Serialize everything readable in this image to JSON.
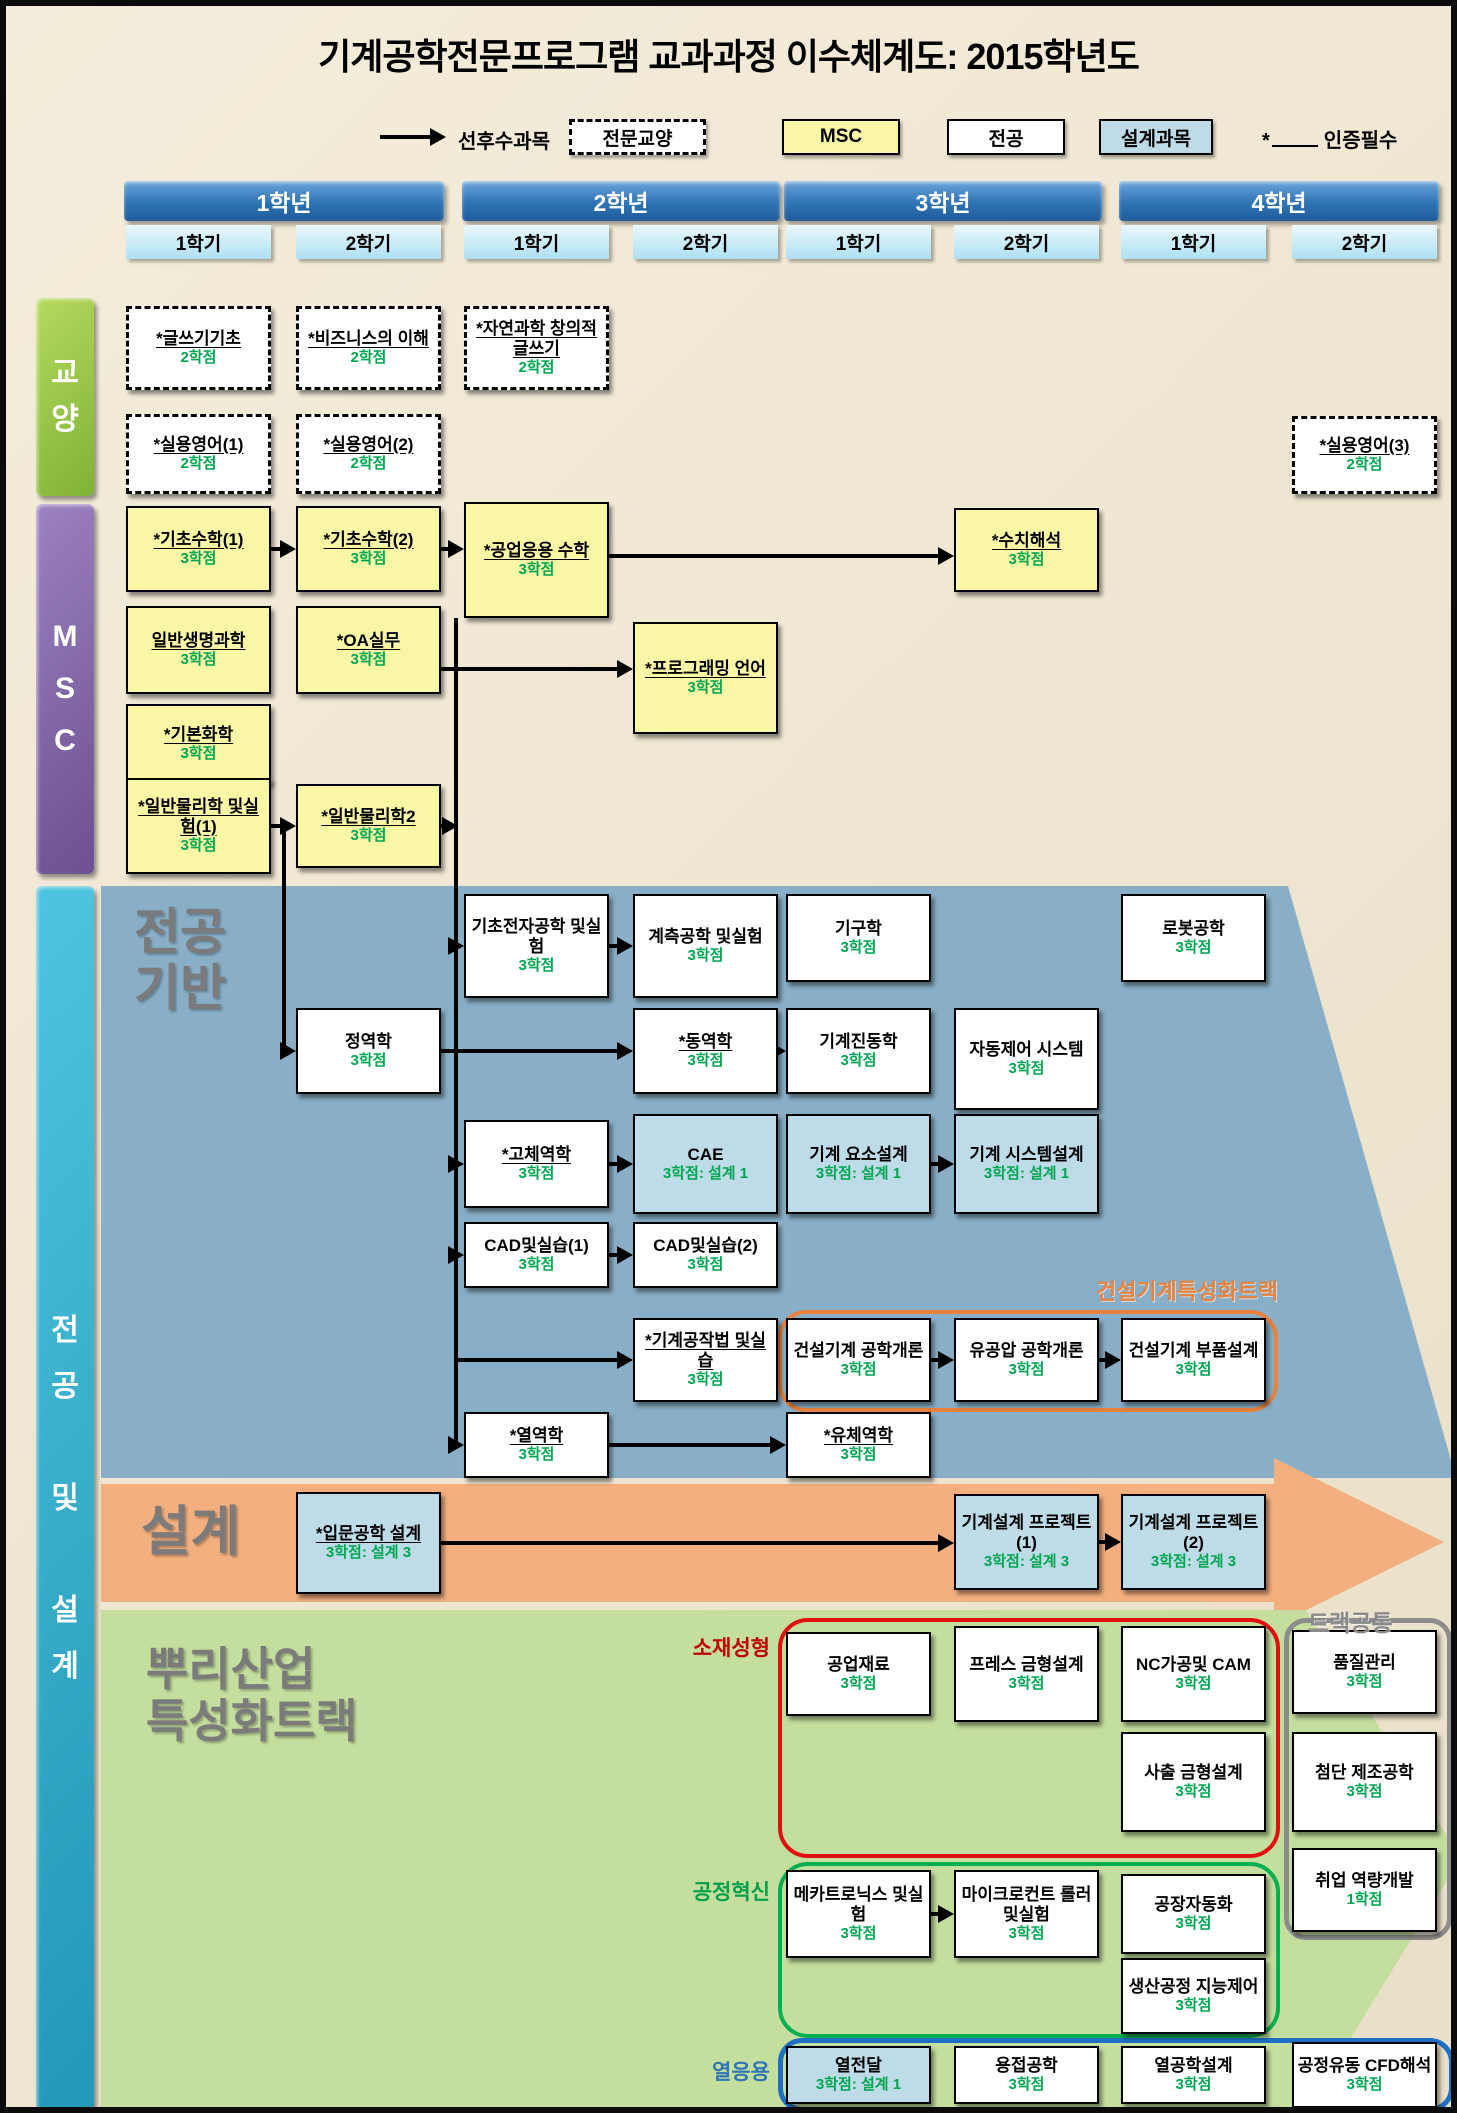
{
  "title": "기계공학전문프로그램 교과과정 이수체계도: 2015학년도",
  "legend": {
    "arrow_label": "선후수과목",
    "box_labels": {
      "ge": "전문교양",
      "msc": "MSC",
      "major": "전공",
      "design": "설계과목"
    },
    "star": "*",
    "star_label": "인증필수"
  },
  "years": [
    {
      "label": "1학년",
      "semesters": [
        "1학기",
        "2학기"
      ]
    },
    {
      "label": "2학년",
      "semesters": [
        "1학기",
        "2학기"
      ]
    },
    {
      "label": "3학년",
      "semesters": [
        "1학기",
        "2학기"
      ]
    },
    {
      "label": "4학년",
      "semesters": [
        "1학기",
        "2학기"
      ]
    }
  ],
  "sidebar": {
    "ge": "교양",
    "msc": "MSC",
    "major_design": "전공 및 설계"
  },
  "sections": {
    "major_base": [
      "전공",
      "기반"
    ],
    "design": "설계",
    "root": [
      "뿌리산업",
      "특성화트랙"
    ],
    "construction_track": "건설기계특성화트랙",
    "track_common": "트랙공통",
    "material_forming": "소재성형",
    "process_innovation": "공정혁신",
    "thermal_application": "열응용"
  },
  "colors": {
    "msc_box": "#F9F6A5",
    "design_box": "#BEDCE8",
    "major_box": "#FFFFFF",
    "credit_green": "#00A651",
    "blue_band": "#88AFC7",
    "orange_band": "#F3AF7E",
    "green_band": "#C4DE9E",
    "construction_label": "#E8823C",
    "material_label": "#C00000",
    "process_label": "#00A04A",
    "thermal_label": "#2E75B6",
    "track_common_label": "#8A8A8A"
  },
  "courses": {
    "writing": {
      "n": "*글쓰기기초",
      "c": "2학점",
      "u": true
    },
    "business": {
      "n": "*비즈니스의 이해",
      "c": "2학점",
      "u": true
    },
    "sciwriting": {
      "n": "*자연과학 창의적글쓰기",
      "c": "2학점",
      "u": true
    },
    "english1": {
      "n": "*실용영어(1)",
      "c": "2학점",
      "u": true
    },
    "english2": {
      "n": "*실용영어(2)",
      "c": "2학점",
      "u": true
    },
    "english3": {
      "n": "*실용영어(3)",
      "c": "2학점",
      "u": true
    },
    "math1": {
      "n": "*기초수학(1)",
      "c": "3학점",
      "u": true
    },
    "math2": {
      "n": "*기초수학(2)",
      "c": "3학점",
      "u": true
    },
    "engmath": {
      "n": "*공업응용 수학",
      "c": "3학점",
      "u": true
    },
    "numanalysis": {
      "n": "*수치해석",
      "c": "3학점",
      "u": true
    },
    "biology": {
      "n": "일반생명과학",
      "c": "3학점",
      "u": true
    },
    "oa": {
      "n": "*OA실무",
      "c": "3학점",
      "u": true
    },
    "programming": {
      "n": "*프로그래밍 언어",
      "c": "3학점",
      "u": true
    },
    "chemistry": {
      "n": "*기본화학",
      "c": "3학점",
      "u": true
    },
    "physics1": {
      "n": "*일반물리학 및실험(1)",
      "c": "3학점",
      "u": true
    },
    "physics2": {
      "n": "*일반물리학2",
      "c": "3학점",
      "u": true
    },
    "electronics": {
      "n": "기초전자공학 및실험",
      "c": "3학점"
    },
    "instrumentation": {
      "n": "계측공학 및실험",
      "c": "3학점"
    },
    "kinematics": {
      "n": "기구학",
      "c": "3학점"
    },
    "robotics": {
      "n": "로봇공학",
      "c": "3학점"
    },
    "statics": {
      "n": "정역학",
      "c": "3학점"
    },
    "dynamics": {
      "n": "*동역학",
      "c": "3학점",
      "u": true
    },
    "vibration": {
      "n": "기계진동학",
      "c": "3학점"
    },
    "autocontrol": {
      "n": "자동제어 시스템",
      "c": "3학점"
    },
    "solid": {
      "n": "*고체역학",
      "c": "3학점",
      "u": true
    },
    "cae": {
      "n": "CAE",
      "c": "3학점: 설계 1"
    },
    "element": {
      "n": "기계 요소설계",
      "c": "3학점: 설계 1"
    },
    "system": {
      "n": "기계 시스템설계",
      "c": "3학점: 설계 1"
    },
    "cad1": {
      "n": "CAD및실습(1)",
      "c": "3학점"
    },
    "cad2": {
      "n": "CAD및실습(2)",
      "c": "3학점"
    },
    "manufacturing": {
      "n": "*기계공작법 및실습",
      "c": "3학점",
      "u": true
    },
    "constintro": {
      "n": "건설기계 공학개론",
      "c": "3학점"
    },
    "hydraulics": {
      "n": "유공압 공학개론",
      "c": "3학점"
    },
    "constparts": {
      "n": "건설기계 부품설계",
      "c": "3학점"
    },
    "thermo": {
      "n": "*열역학",
      "c": "3학점",
      "u": true
    },
    "fluid": {
      "n": "*유체역학",
      "c": "3학점",
      "u": true
    },
    "introdesign": {
      "n": "*입문공학 설계",
      "c": "3학점: 설계 3",
      "u": true
    },
    "project1": {
      "n": "기계설계 프로젝트(1)",
      "c": "3학점: 설계 3"
    },
    "project2": {
      "n": "기계설계 프로젝트(2)",
      "c": "3학점: 설계 3"
    },
    "materials": {
      "n": "공업재료",
      "c": "3학점"
    },
    "press": {
      "n": "프레스 금형설계",
      "c": "3학점"
    },
    "nccam": {
      "n": "NC가공및 CAM",
      "c": "3학점"
    },
    "injection": {
      "n": "사출 금형설계",
      "c": "3학점"
    },
    "quality": {
      "n": "품질관리",
      "c": "3학점"
    },
    "advman": {
      "n": "첨단 제조공학",
      "c": "3학점"
    },
    "career": {
      "n": "취업 역량개발",
      "c": "1학점"
    },
    "mechatronics": {
      "n": "메카트로닉스 및실험",
      "c": "3학점"
    },
    "micro": {
      "n": "마이크로컨트 롤러및실험",
      "c": "3학점"
    },
    "factoryauto": {
      "n": "공장자동화",
      "c": "3학점"
    },
    "production": {
      "n": "생산공정 지능제어",
      "c": "3학점"
    },
    "heattransfer": {
      "n": "열전달",
      "c": "3학점: 설계 1"
    },
    "welding": {
      "n": "용접공학",
      "c": "3학점"
    },
    "thermaldesign": {
      "n": "열공학설계",
      "c": "3학점"
    },
    "cfd": {
      "n": "공정유동 CFD해석",
      "c": "3학점"
    }
  }
}
